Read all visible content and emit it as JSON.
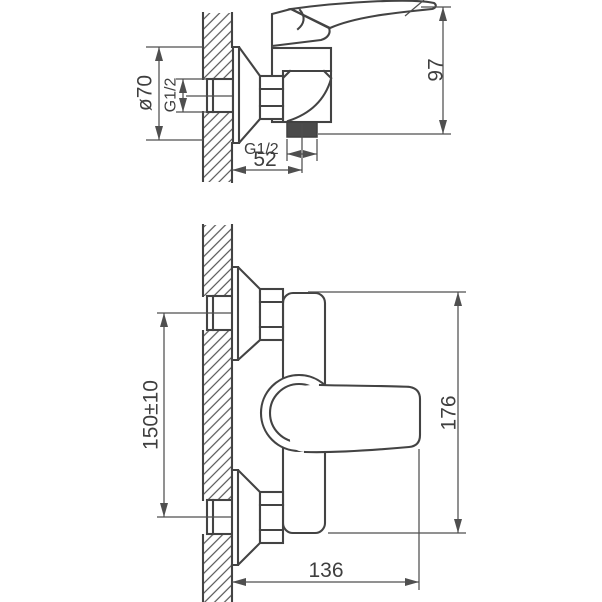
{
  "meta": {
    "background": "#ffffff",
    "line_color": "#434343",
    "dark_fill": "#4a4a4a"
  },
  "side_view": {
    "label": "wall-mounted shower mixer, side section view",
    "dims": {
      "flange_diameter": "ø70",
      "inlet_thread": "G1/2",
      "height": "97",
      "outlet_thread": "G1/2",
      "outlet_offset": "52"
    }
  },
  "front_view": {
    "label": "wall-mounted shower mixer, plan view",
    "dims": {
      "inlet_spacing": "150±10",
      "overall_length": "176",
      "projection": "136"
    }
  }
}
